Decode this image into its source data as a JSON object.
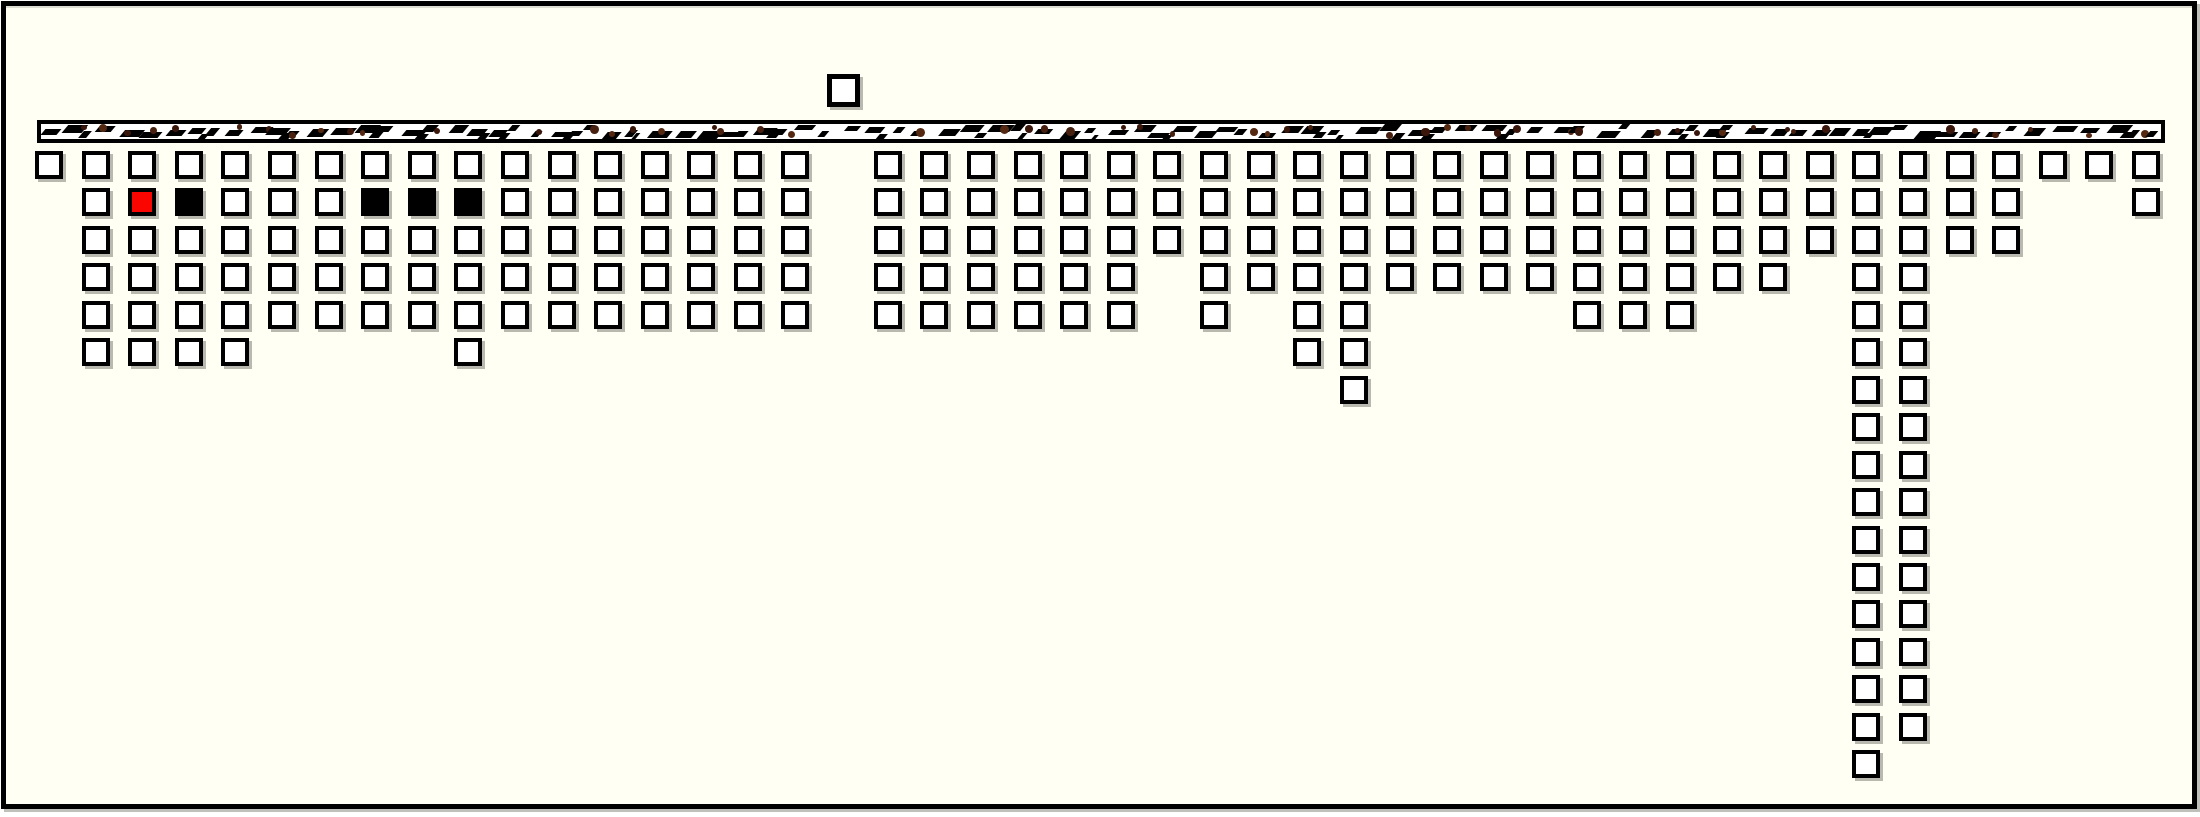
{
  "canvas": {
    "width": 2200,
    "height": 817,
    "page_bg": "#ffffff",
    "board_bg": "#fffff4",
    "frame": {
      "left": 1,
      "top": 1,
      "width": 2196,
      "height": 808,
      "border_px": 5,
      "border_color": "#000000"
    }
  },
  "palette": {
    "square_fill": "#ffffff",
    "square_border": "#000000",
    "red_square": "#fb0500",
    "black_square": "#000000",
    "strip_bg": "#ffffff",
    "strip_mark_black": "#000000",
    "strip_dot_browns": [
      "#48200f",
      "#3a160b",
      "#552812"
    ],
    "shadow": "rgba(115,115,105,0.5)"
  },
  "strip": {
    "left": 37,
    "top": 120,
    "width": 2128,
    "height": 23,
    "border_px": 4,
    "pattern": {
      "seed": 7,
      "step_min": 15,
      "step_max": 29,
      "dash_w_min": 7,
      "dash_w_max": 22,
      "dash_h_min": 5,
      "dash_h_max": 8,
      "dot_d_min": 5,
      "dot_d_max": 9,
      "dot_probability": 0.62,
      "second_dash_probability": 0.3
    }
  },
  "floating_square": {
    "col": 18,
    "left": 827,
    "top": 74,
    "size": 33
  },
  "grid": {
    "origin_x": 35,
    "origin_y": 151,
    "pitch_x": 46.6,
    "pitch_y": 37.45,
    "square_size": 28,
    "column_depths": [
      1,
      6,
      6,
      6,
      6,
      5,
      5,
      5,
      5,
      6,
      5,
      5,
      5,
      5,
      5,
      5,
      5,
      0,
      5,
      5,
      5,
      5,
      5,
      5,
      3,
      5,
      4,
      6,
      7,
      4,
      4,
      4,
      4,
      5,
      5,
      5,
      4,
      4,
      3,
      17,
      16,
      3,
      3,
      1,
      1,
      2
    ],
    "special_squares": [
      {
        "col": 3,
        "row": 2,
        "state": "red"
      },
      {
        "col": 4,
        "row": 2,
        "state": "black"
      },
      {
        "col": 8,
        "row": 2,
        "state": "black"
      },
      {
        "col": 9,
        "row": 2,
        "state": "black"
      },
      {
        "col": 10,
        "row": 2,
        "state": "black"
      }
    ]
  }
}
